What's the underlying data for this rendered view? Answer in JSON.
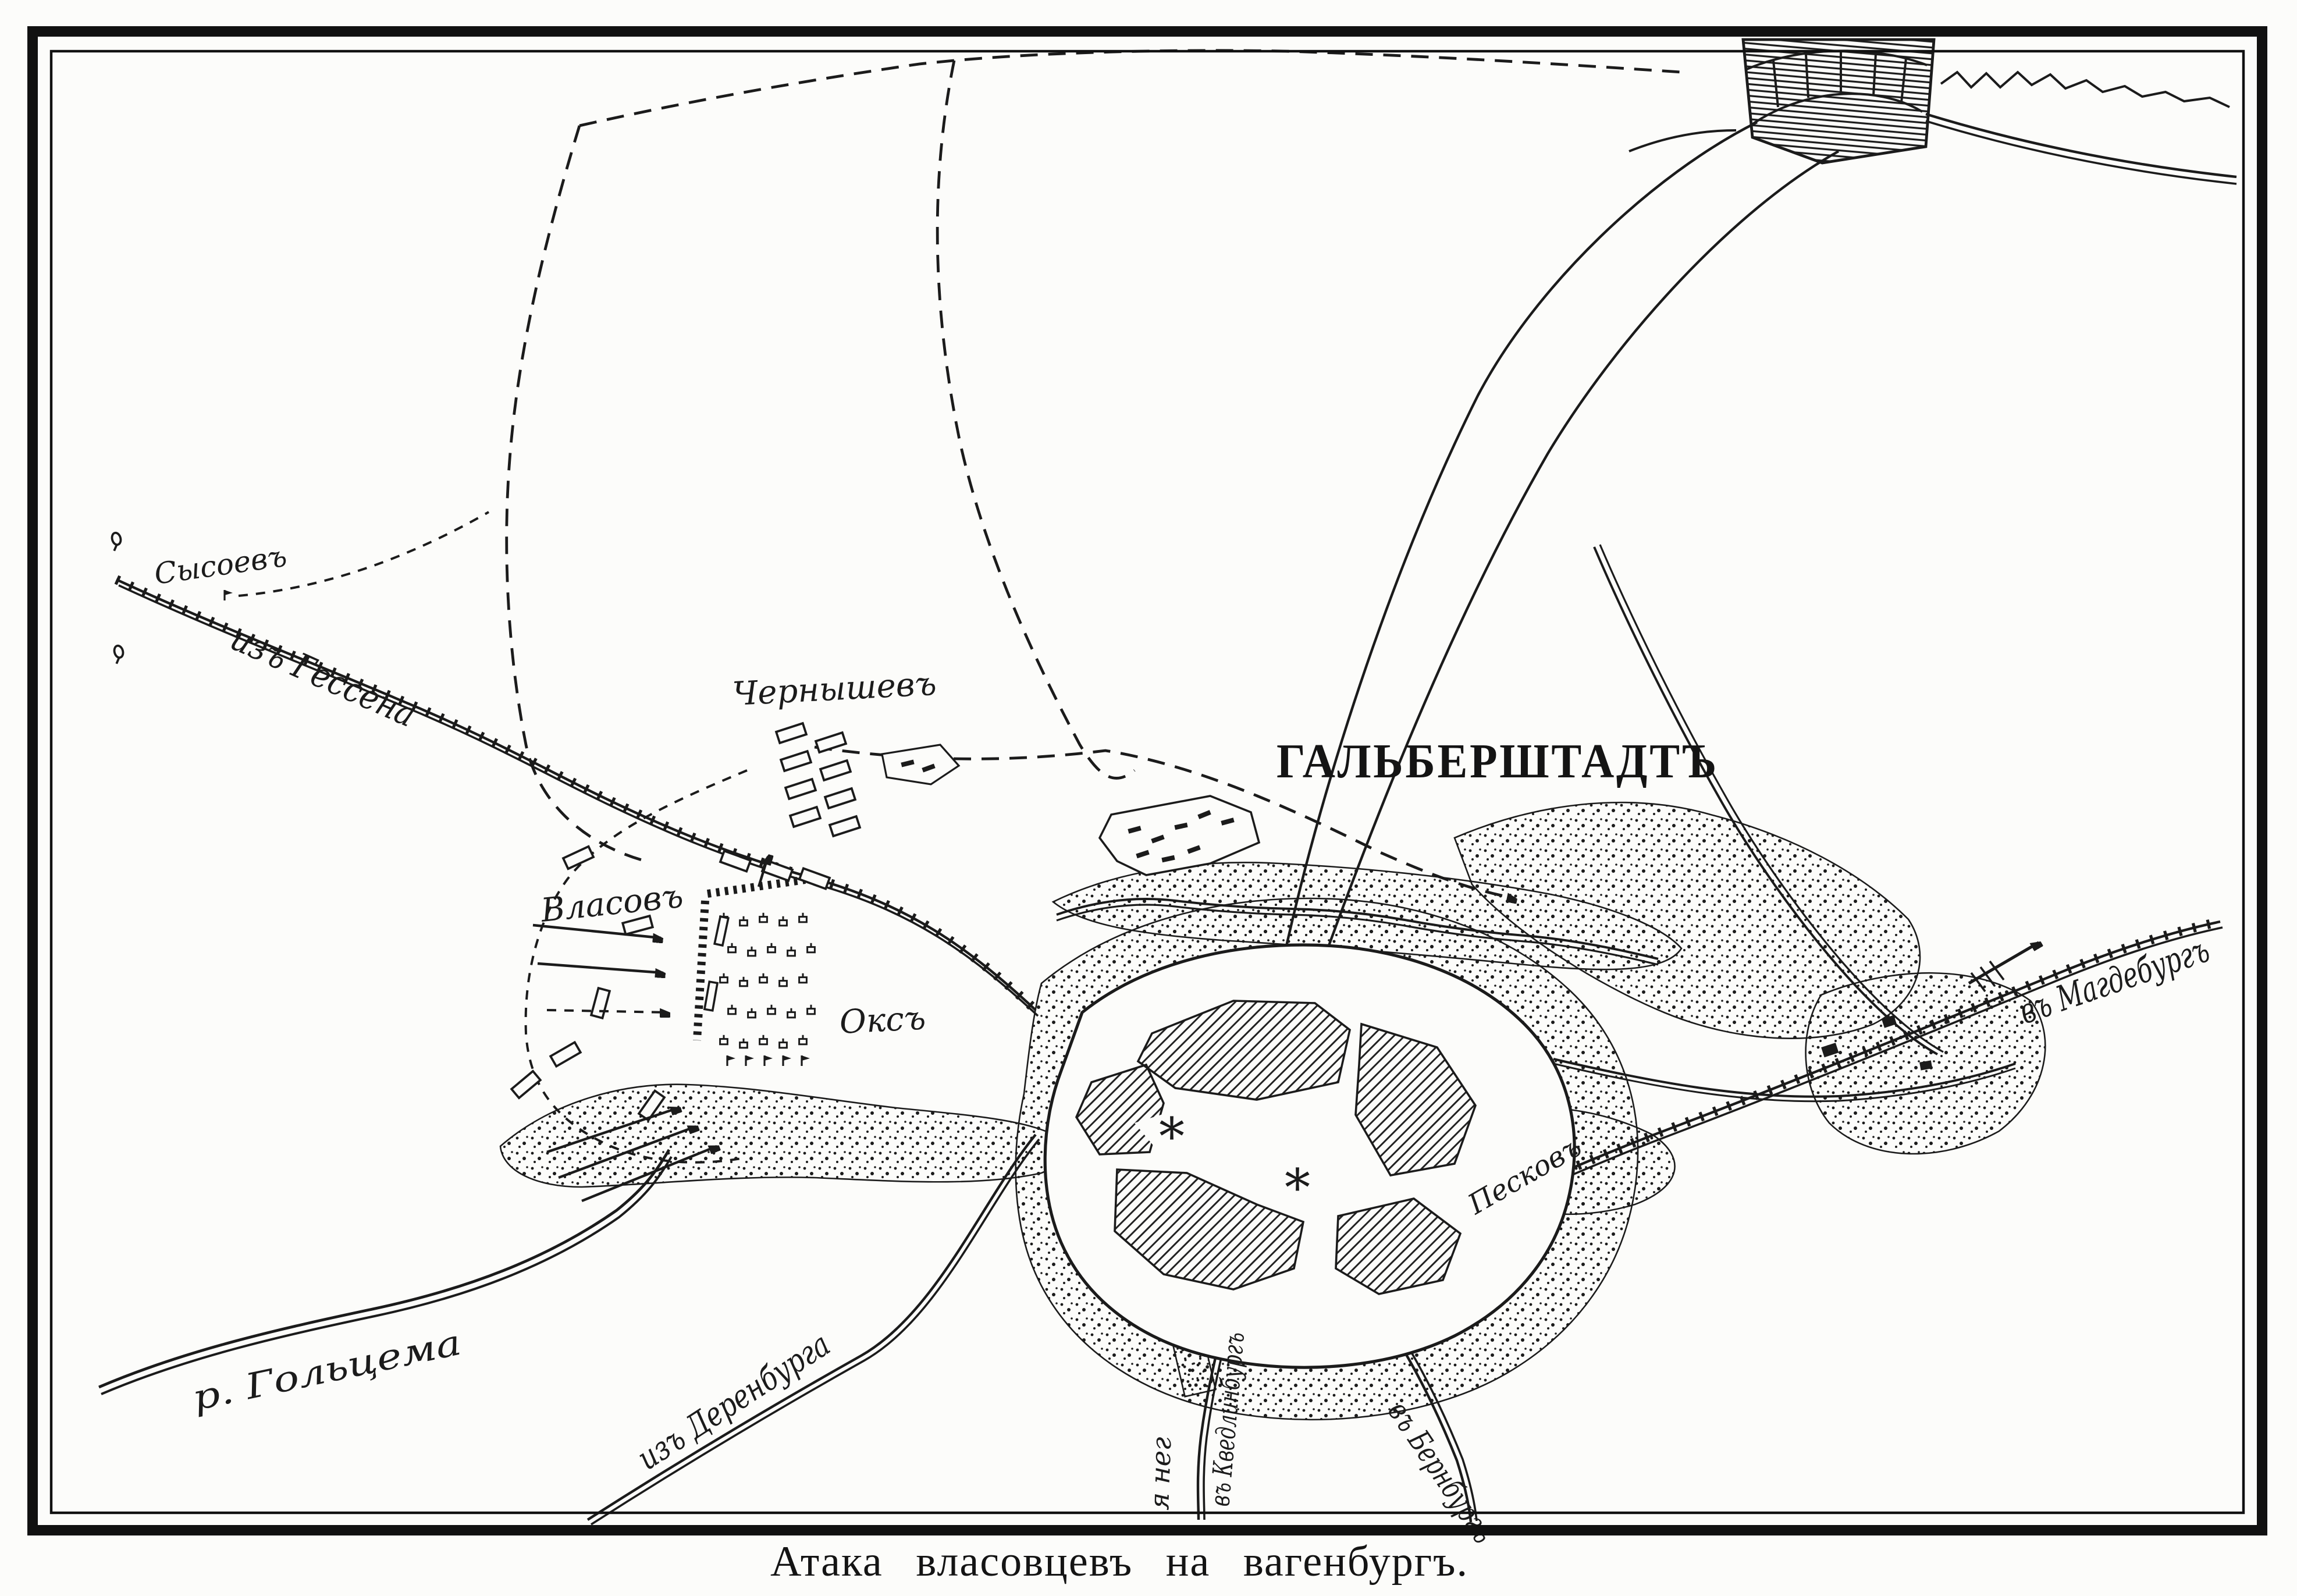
{
  "page": {
    "caption": "Атака власовцевъ на вагенбургъ.",
    "colors": {
      "ink": "#1b1b1b",
      "paper": "#fcfcfa"
    }
  },
  "map": {
    "title": "ГАЛЬБЕРШТАДТЪ",
    "commanders": {
      "sysoev": "Сысоевъ",
      "chernyshev": "Чернышевъ",
      "vlasov": "Власовъ",
      "oks": "Оксъ",
      "peskov": "Песковъ"
    },
    "roads": {
      "from_hessen": "изъ Гессена",
      "from_derenburg": "изъ Деренбурга",
      "to_magdeburg": "въ Магдебургъ",
      "to_bernburg": "въ Бернбургъ",
      "to_quedlinburg": "въ Кведлинбургъ",
      "south_fragment": "я нег"
    },
    "river": "р. Гольцема",
    "church_marks": [
      "*",
      "*"
    ]
  }
}
